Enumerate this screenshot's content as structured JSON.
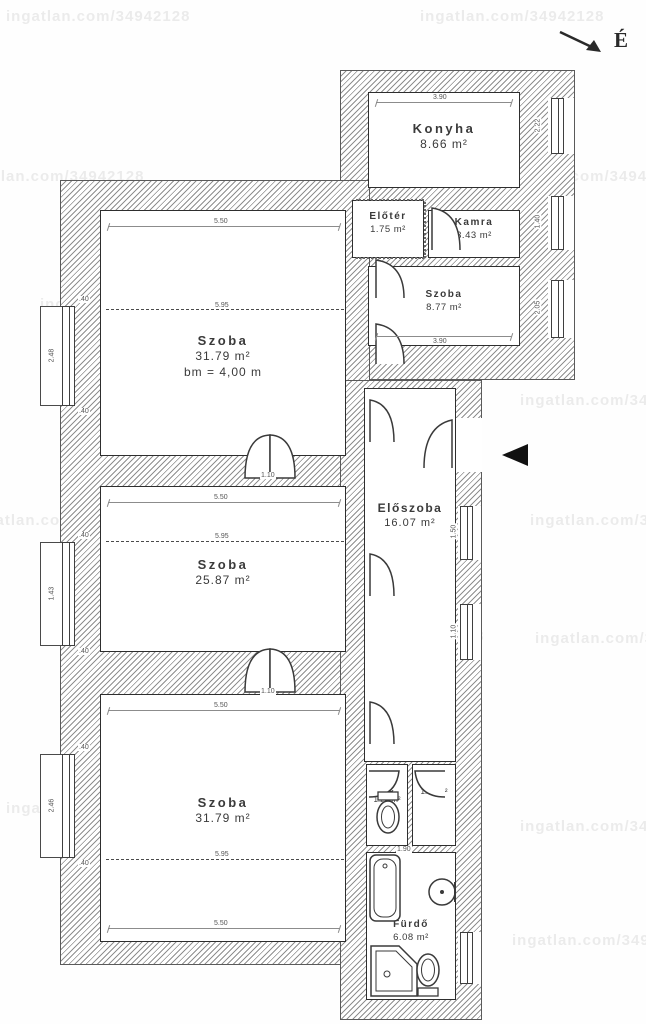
{
  "watermark": {
    "text": "ingatlan.com/34942128"
  },
  "north": {
    "label": "É"
  },
  "rooms": [
    {
      "id": "konyha",
      "name": "Konyha",
      "area": "8.66 m²"
    },
    {
      "id": "eloter",
      "name": "Előtér",
      "area": "1.75 m²"
    },
    {
      "id": "kamra",
      "name": "Kamra",
      "area": "3.43 m²"
    },
    {
      "id": "szoba-kis",
      "name": "Szoba",
      "area": "8.77 m²"
    },
    {
      "id": "szoba-felso",
      "name": "Szoba",
      "area": "31.79 m²",
      "note": "bm = 4,00 m"
    },
    {
      "id": "eloszoba",
      "name": "Előszoba",
      "area": "16.07 m²"
    },
    {
      "id": "szoba-kozepso",
      "name": "Szoba",
      "area": "25.87 m²"
    },
    {
      "id": "szoba-also",
      "name": "Szoba",
      "area": "31.79 m²"
    },
    {
      "id": "wc",
      "name": "WC",
      "area": "1.20 m²"
    },
    {
      "id": "kozlekedo",
      "name": "",
      "area": "1.59 m²"
    },
    {
      "id": "furdo",
      "name": "Fürdő",
      "area": "6.08 m²"
    }
  ],
  "dims": [
    "3.90",
    "5.50",
    "5.95",
    "1.10",
    "5.50",
    "5.95",
    "1.10",
    "5.50",
    "5.95",
    "5.50",
    "3.90",
    ".40",
    "2.48",
    ".40",
    ".40",
    "1.43",
    ".40",
    ".40",
    "2.46",
    ".40",
    "2.22",
    "1.40",
    "2.05",
    "1.50",
    "1.10",
    "1.90"
  ],
  "colors": {
    "line": "#2e2e2e",
    "hatch": "#8f8f8f",
    "dim": "#8c8c8c",
    "entrance": "#111111"
  }
}
